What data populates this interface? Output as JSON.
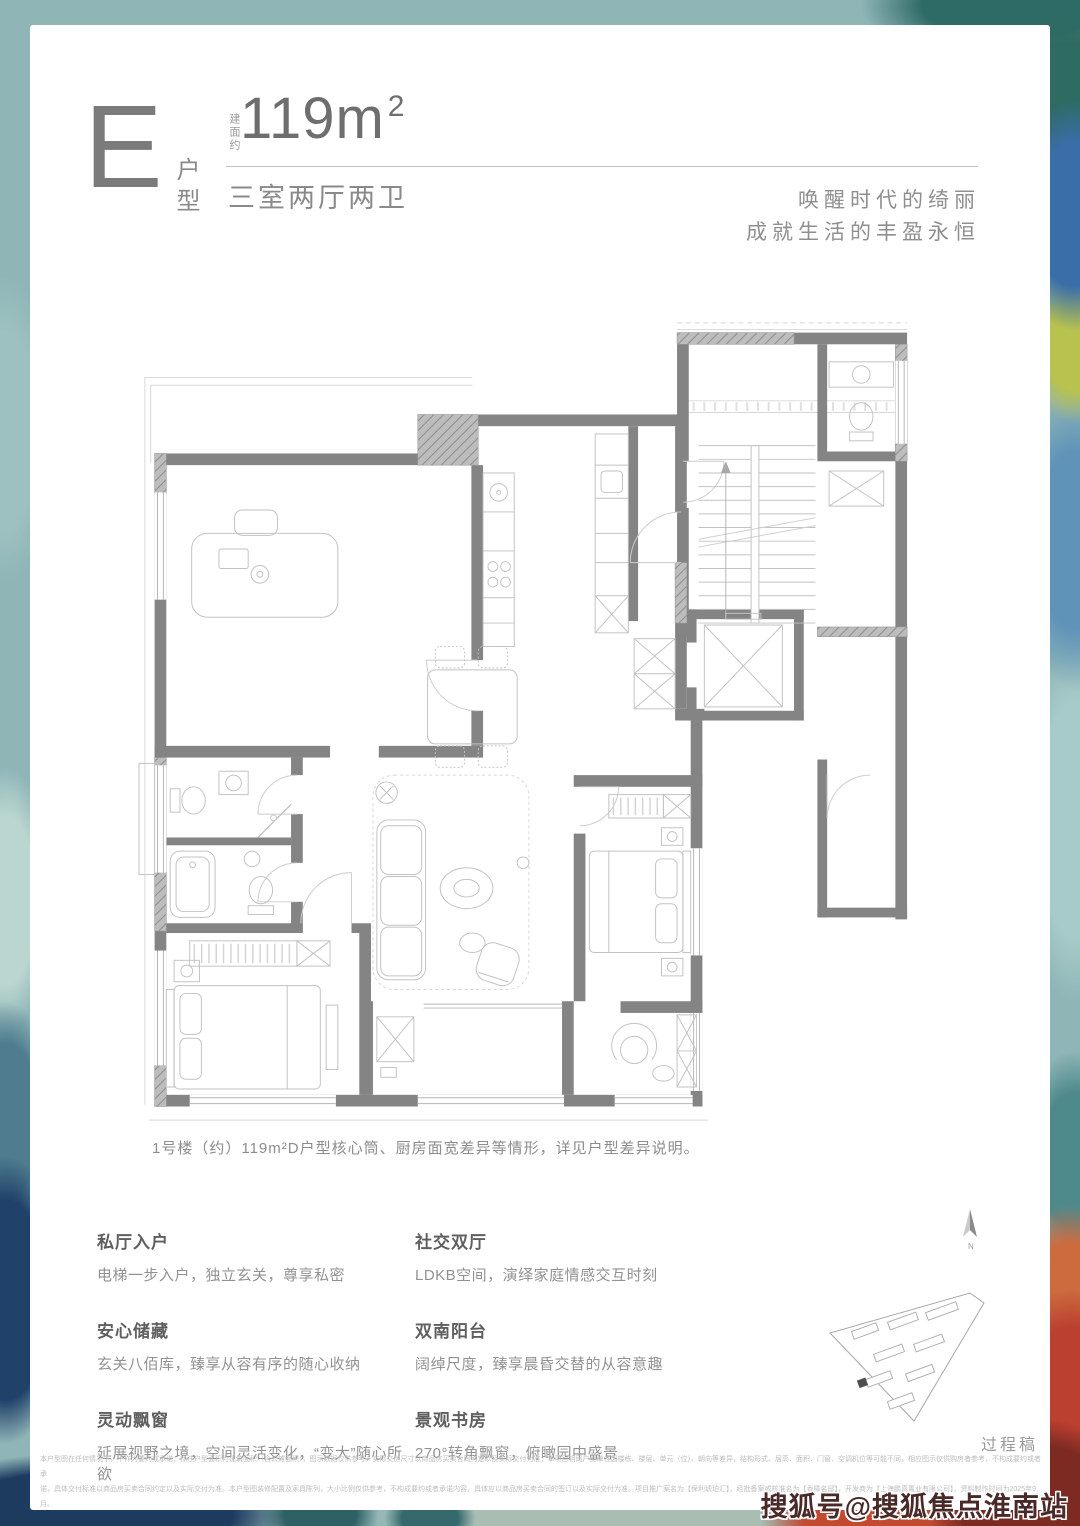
{
  "colors": {
    "frame_teal": "#8fb5b7",
    "page_bg": "#ffffff",
    "wall_gray": "#848484",
    "title_gray": "#5f5f5f",
    "body_gray": "#929292",
    "accent_red": "#bb4030",
    "watermark_color": "#4a2a28"
  },
  "header": {
    "unit_letter": "E",
    "unit_type_label": "户型",
    "area_prefix": "建面约",
    "area_value": "119m",
    "area_sup": "2",
    "layout_text": "三室两厅两卫",
    "slogan_line1": "唤醒时代的绮丽",
    "slogan_line2": "成就生活的丰盈永恒"
  },
  "floorplan": {
    "caption": "1号楼（约）119m²D户型核心筒、厨房面宽差异等情形，详见户型差异说明。"
  },
  "features": [
    {
      "title": "私厅入户",
      "desc": "电梯一步入户，独立玄关，尊享私密"
    },
    {
      "title": "社交双厅",
      "desc": "LDKB空间，演绎家庭情感交互时刻"
    },
    {
      "title": "安心储藏",
      "desc": "玄关八佰库，臻享从容有序的随心收纳"
    },
    {
      "title": "双南阳台",
      "desc": "阔绰尺度，臻享晨昏交替的从容意趣"
    },
    {
      "title": "灵动飘窗",
      "desc": "延展视野之境，空间灵活变化，“变大”随心所欲"
    },
    {
      "title": "景观书房",
      "desc": "270°转角飘窗，俯瞰园中盛景"
    }
  ],
  "sitemap": {
    "north_label": "N",
    "draft_label": "过程稿"
  },
  "disclaimer": {
    "line1": "本户型图在任何情况下，不作为要约或承诺；标注户型面积为建筑面积（含公摊面积），图示数据仅供参考，实际交房尺寸以商品房买卖合同约定以及实际交付为准；本项目相同户型单位因楼栋、楼层、单元（位）、朝向等差异，结构形式、层高、面积、门窗、空调机位等可能不同，相应图示仅供购房者参考，不构成要约或者承",
    "line2": "诺，具体交付标准以商品房买卖合同约定以及实际交付为准。本户型图装修配置及家具陈列，大小比例仅供参考，不构成要约或者承诺内容，具体应以商品房买卖合同的签订以及实际交付为准。项目推广案名为【保利琥珀汇】，经批备案或核准名为【香樟名邸】，开发商为【上海鹏真置业有限公司】，资料制作时间为2025年9月。"
  },
  "watermark": {
    "text": "搜狐号@搜狐焦点淮南站"
  }
}
